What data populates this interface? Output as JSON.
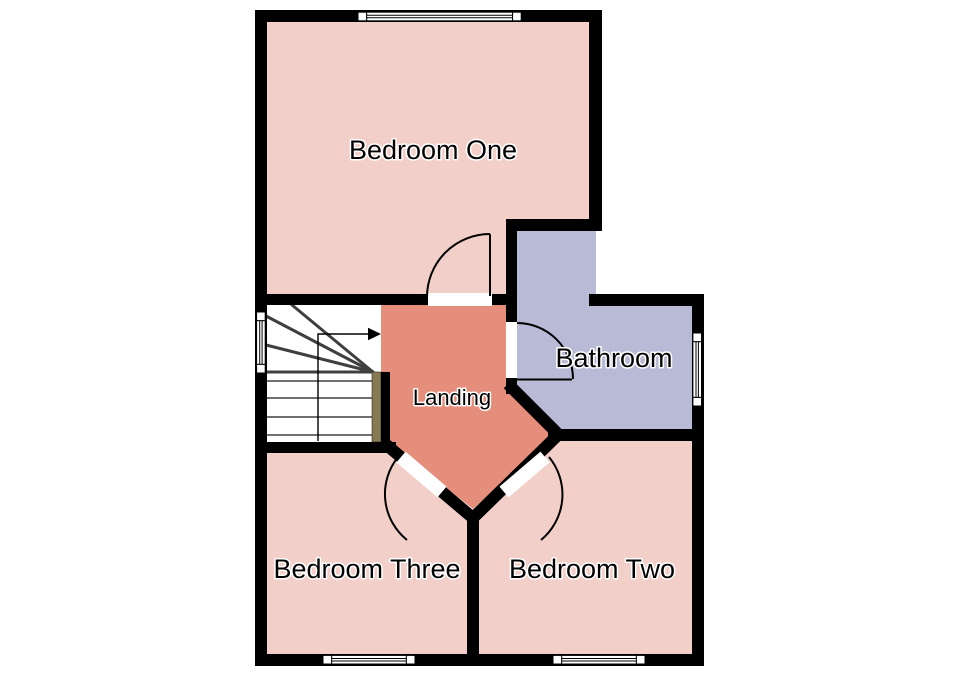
{
  "floorplan": {
    "background": "#ffffff",
    "wall_color": "#000000",
    "rooms": [
      {
        "id": "bedroom-one",
        "label": "Bedroom One",
        "fill": "#f2d0c9"
      },
      {
        "id": "bathroom",
        "label": "Bathroom",
        "fill": "#b9bad6"
      },
      {
        "id": "landing",
        "label": "Landing",
        "fill": "#e68e7c"
      },
      {
        "id": "bedroom-three",
        "label": "Bedroom Three",
        "fill": "#f2d0c9"
      },
      {
        "id": "bedroom-two",
        "label": "Bedroom Two",
        "fill": "#f2d0c9"
      }
    ],
    "features": {
      "stairs": {
        "banister_fill": "#877a52",
        "direction": "up-arrow-right"
      },
      "windows": [
        "bedroom-one-top",
        "stairs-left",
        "bathroom-right",
        "bedroom-three-bottom",
        "bedroom-two-bottom"
      ],
      "doors": [
        "bedroom-one",
        "bathroom",
        "bedroom-three",
        "bedroom-two"
      ]
    }
  }
}
